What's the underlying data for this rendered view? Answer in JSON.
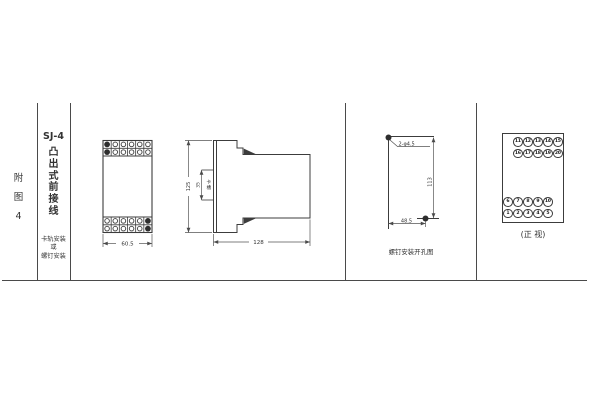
{
  "frame": {
    "line_color": "#4a4a4a"
  },
  "sidebar": {
    "figure_chars": [
      "附",
      "图",
      "4"
    ],
    "model": "SJ-4",
    "type_chars": [
      "凸",
      "出",
      "式",
      "前",
      "接",
      "线"
    ],
    "mount_lines": [
      "卡轨安装",
      "或",
      "螺钉安装"
    ]
  },
  "front_view": {
    "width_dim": "60.5"
  },
  "side_view": {
    "height_dim": "125",
    "slot_dim": "35",
    "slot_chars": [
      "卡",
      "槽"
    ],
    "depth_dim": "128"
  },
  "drill_view": {
    "hole_label": "2-φ4.5",
    "height_dim": "113",
    "width_dim": "48.5",
    "caption": "螺钉安装开孔图"
  },
  "terminal_view": {
    "rows": [
      [
        "11",
        "12",
        "13",
        "14",
        "15"
      ],
      [
        "16",
        "17",
        "18",
        "19",
        "20"
      ],
      [
        "6",
        "7",
        "8",
        "9",
        "10"
      ],
      [
        "1",
        "2",
        "3",
        "4",
        "5"
      ]
    ],
    "caption": "(正 视)"
  }
}
